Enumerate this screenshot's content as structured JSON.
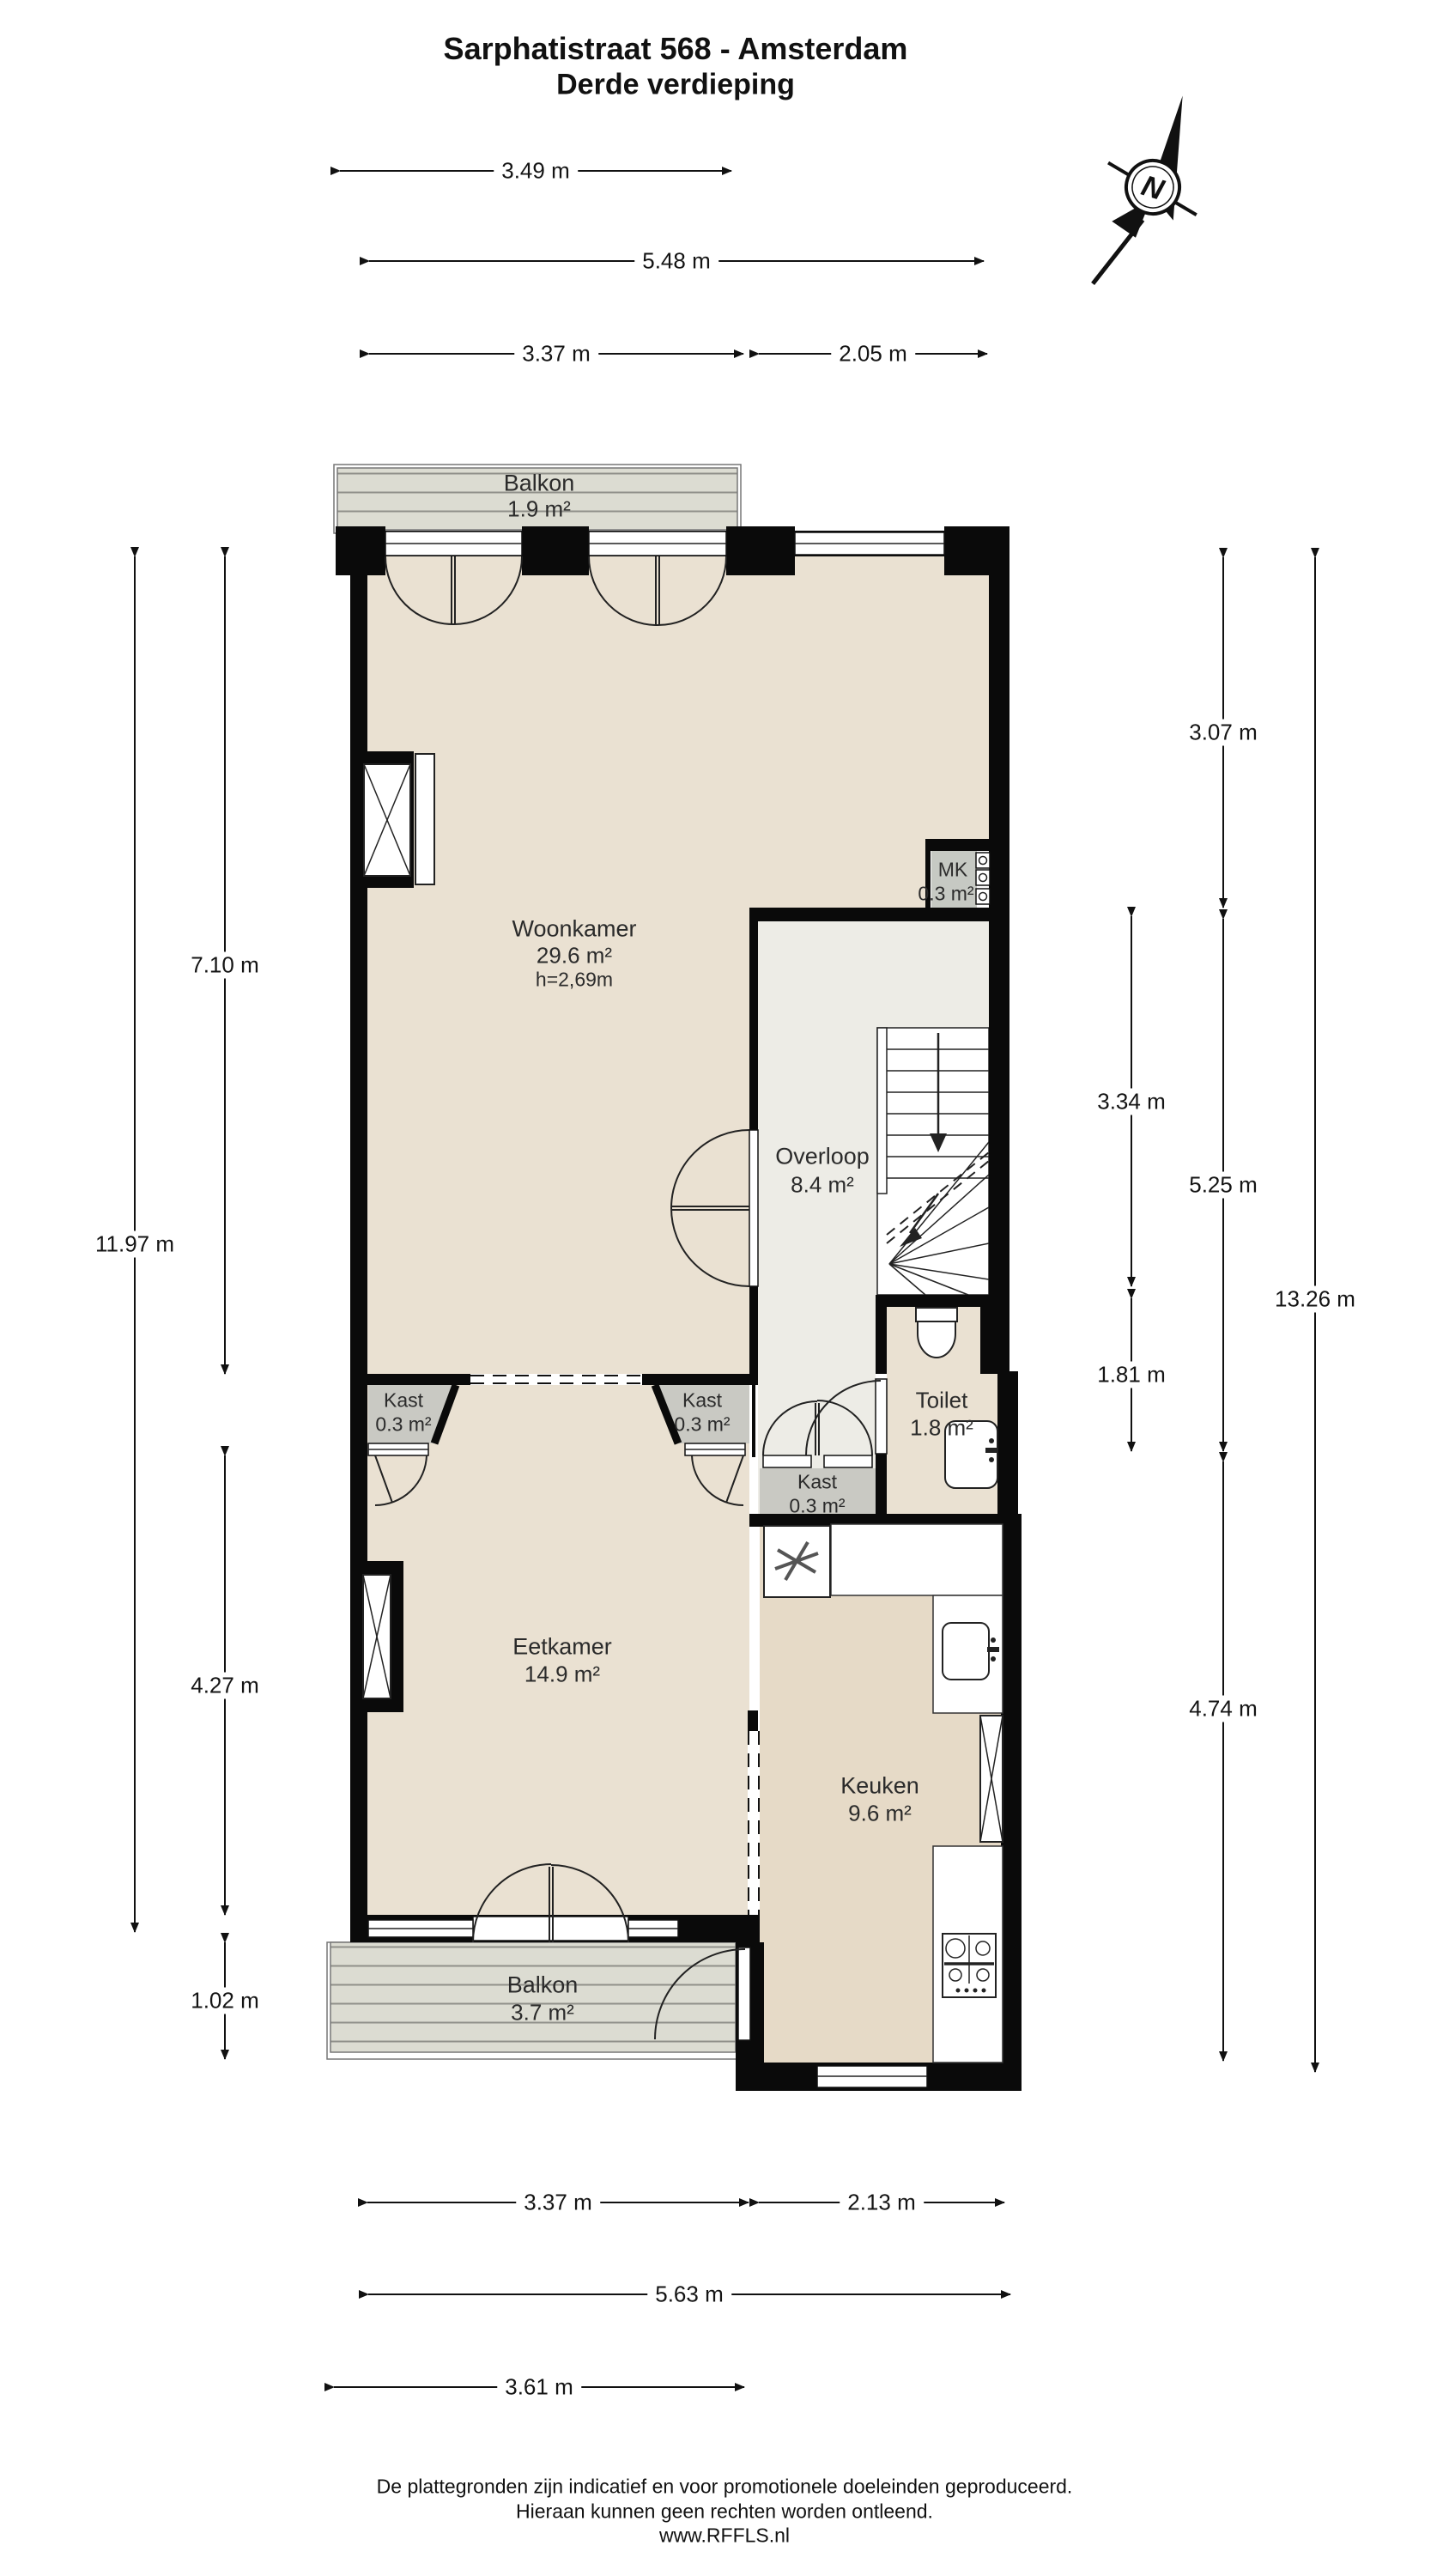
{
  "title": {
    "line1": "Sarphatistraat 568 - Amsterdam",
    "line2": "Derde verdieping"
  },
  "compass": {
    "label": "N"
  },
  "rooms": {
    "balkon_top": {
      "name": "Balkon",
      "area": "1.9 m²"
    },
    "woonkamer": {
      "name": "Woonkamer",
      "area": "29.6 m²",
      "height": "h=2,69m"
    },
    "mk": {
      "name": "MK",
      "area": "0.3 m²"
    },
    "overloop": {
      "name": "Overloop",
      "area": "8.4 m²"
    },
    "toilet": {
      "name": "Toilet",
      "area": "1.8 m²"
    },
    "kast_left": {
      "name": "Kast",
      "area": "0.3 m²"
    },
    "kast_right": {
      "name": "Kast",
      "area": "0.3 m²"
    },
    "kast_hal": {
      "name": "Kast",
      "area": "0.3 m²"
    },
    "eetkamer": {
      "name": "Eetkamer",
      "area": "14.9 m²"
    },
    "keuken": {
      "name": "Keuken",
      "area": "9.6 m²"
    },
    "balkon_bottom": {
      "name": "Balkon",
      "area": "3.7 m²"
    }
  },
  "dimensions": {
    "top": [
      {
        "label": "3.49 m"
      },
      {
        "label": "5.48 m"
      },
      {
        "label": "3.37 m"
      },
      {
        "label": "2.05 m"
      }
    ],
    "bottom": [
      {
        "label": "3.37 m"
      },
      {
        "label": "2.13 m"
      },
      {
        "label": "5.63 m"
      },
      {
        "label": "3.61 m"
      }
    ],
    "left": [
      {
        "label": "7.10 m"
      },
      {
        "label": "11.97 m"
      },
      {
        "label": "4.27 m"
      },
      {
        "label": "1.02 m"
      }
    ],
    "right": [
      {
        "label": "3.07 m"
      },
      {
        "label": "3.34 m"
      },
      {
        "label": "5.25 m"
      },
      {
        "label": "1.81 m"
      },
      {
        "label": "4.74 m"
      },
      {
        "label": "13.26 m"
      }
    ]
  },
  "footer": {
    "line1": "De plattegronden zijn indicatief en voor promotionele doeleinden geproduceerd.",
    "line2": "Hieraan kunnen geen rechten worden ontleend.",
    "line3": "www.RFFLS.nl"
  },
  "colors": {
    "room_fill": "#eae1d2",
    "kitchen_fill": "#e6dac7",
    "hall_fill": "#edece6",
    "balcony_fill": "#dcdcd2",
    "cabinet_fill": "#c9c9c3",
    "wall": "#0a0a0a"
  }
}
